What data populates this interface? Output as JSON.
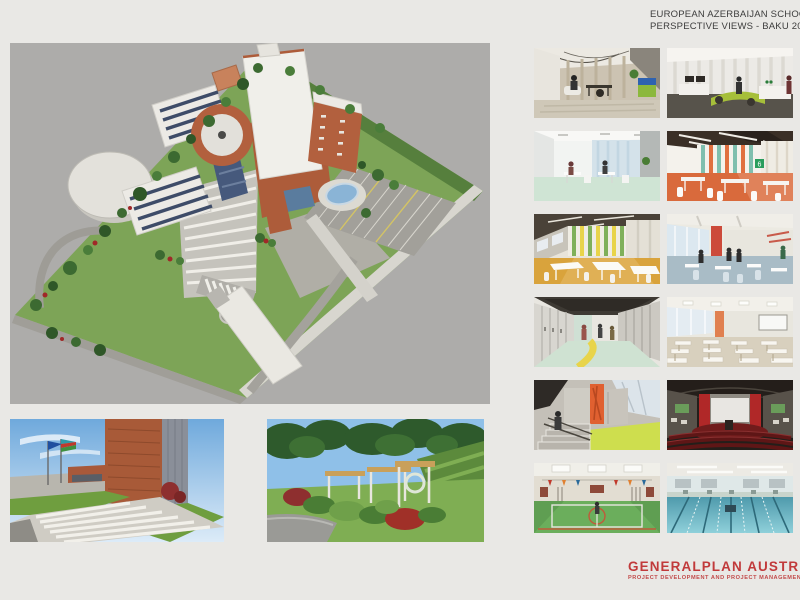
{
  "header": {
    "line1": "EUROPEAN AZERBAIJAN SCHOOL 2",
    "line2": "PERSPECTIVE VIEWS - BAKU 2014"
  },
  "footer": {
    "brand": "GENERALPLAN AUSTRIA",
    "tagline": "PROJECT DEVELOPMENT AND PROJECT MANAGEMENT MMC"
  },
  "colors": {
    "page_bg": "#e9e8e5",
    "panel_bg": "#adacaa",
    "brand_red": "#c13a3b",
    "title_text": "#3d3d3d",
    "brick": "#b2603e",
    "grass": "#7da457",
    "pool_blue": "#8ab4d6"
  },
  "panels": {
    "aerial": {
      "name": "aerial-site-view"
    },
    "entrance": {
      "name": "entrance-perspective-view"
    },
    "garden": {
      "name": "garden-pergola-view"
    },
    "cafeteria_sign": "6",
    "thumbnails": [
      {
        "name": "office-interior-view"
      },
      {
        "name": "reception-lobby-view"
      },
      {
        "name": "meeting-room-view"
      },
      {
        "name": "cafeteria-striped-wall-view"
      },
      {
        "name": "dining-hall-yellow-view"
      },
      {
        "name": "classroom-red-wall-view"
      },
      {
        "name": "locker-corridor-view"
      },
      {
        "name": "classroom-rows-view"
      },
      {
        "name": "staircase-view"
      },
      {
        "name": "auditorium-view"
      },
      {
        "name": "gymnasium-view"
      },
      {
        "name": "swimming-pool-view"
      }
    ]
  }
}
